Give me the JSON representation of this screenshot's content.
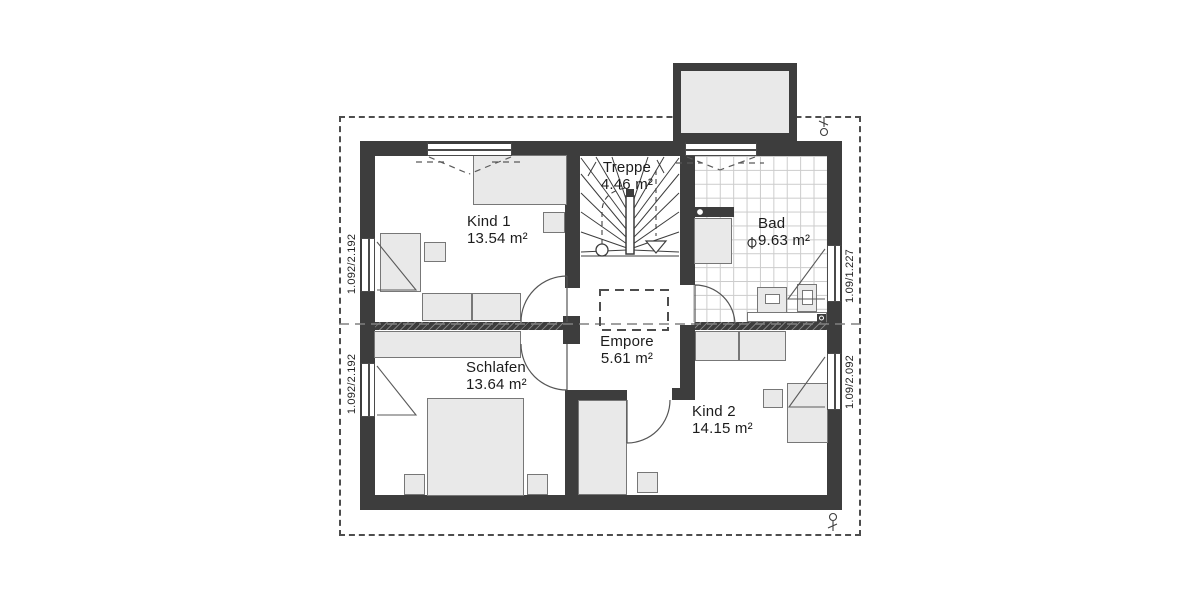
{
  "plan": {
    "title": "Obergeschoss Grundriss",
    "rooms": [
      {
        "name": "Kind 1",
        "area": "13.54 m²"
      },
      {
        "name": "Treppe",
        "area": "4.46 m²"
      },
      {
        "name": "Bad",
        "area": "9.63 m²"
      },
      {
        "name": "Schlafen",
        "area": "13.64 m²"
      },
      {
        "name": "Empore",
        "area": "5.61 m²"
      },
      {
        "name": "Kind 2",
        "area": "14.15 m²"
      }
    ],
    "window_dimensions": {
      "left_upper": "1.092/2.192",
      "left_lower": "1.092/2.192",
      "right_upper": "1.09/1.227",
      "right_lower": "1.09/2.092"
    },
    "colors": {
      "wall": "#3d3d3d",
      "furniture_fill": "#e9e9e9",
      "furniture_border": "#777777",
      "tile_line": "#cccccc",
      "line": "#555555",
      "background": "#ffffff"
    }
  }
}
